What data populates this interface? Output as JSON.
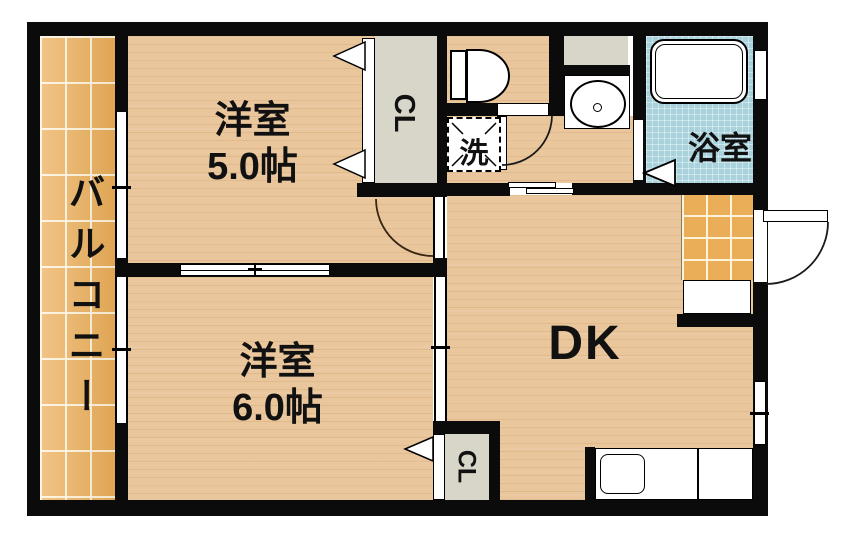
{
  "title": "2DK apartment floor plan",
  "labels": {
    "balcony": "バルコニー",
    "room5": {
      "name": "洋室",
      "size": "5.0帖"
    },
    "room6": {
      "name": "洋室",
      "size": "6.0帖"
    },
    "dk": "DK",
    "bathroom": "浴室",
    "laundry": "洗",
    "closet_top": "CL",
    "closet_bottom": "CL"
  },
  "fixtures": {
    "toilet": "toilet",
    "washbasin": "washbasin",
    "bathtub": "bathtub",
    "washing_machine_space": "washing-machine space (洗)",
    "kitchen_sink": "kitchen sink counter",
    "shoe_cabinet": "shoe cabinet",
    "entry_door": "entry swing door",
    "sliding_doors": "sliding doors / windows"
  },
  "colors": {
    "wall": "#0b0b0b",
    "wood_floor": "#e9c69b",
    "balcony_tile": "#ebae58",
    "bath_tile": "#a9d2dc",
    "closet_gray": "#d8d5c9",
    "text": "#111111"
  }
}
